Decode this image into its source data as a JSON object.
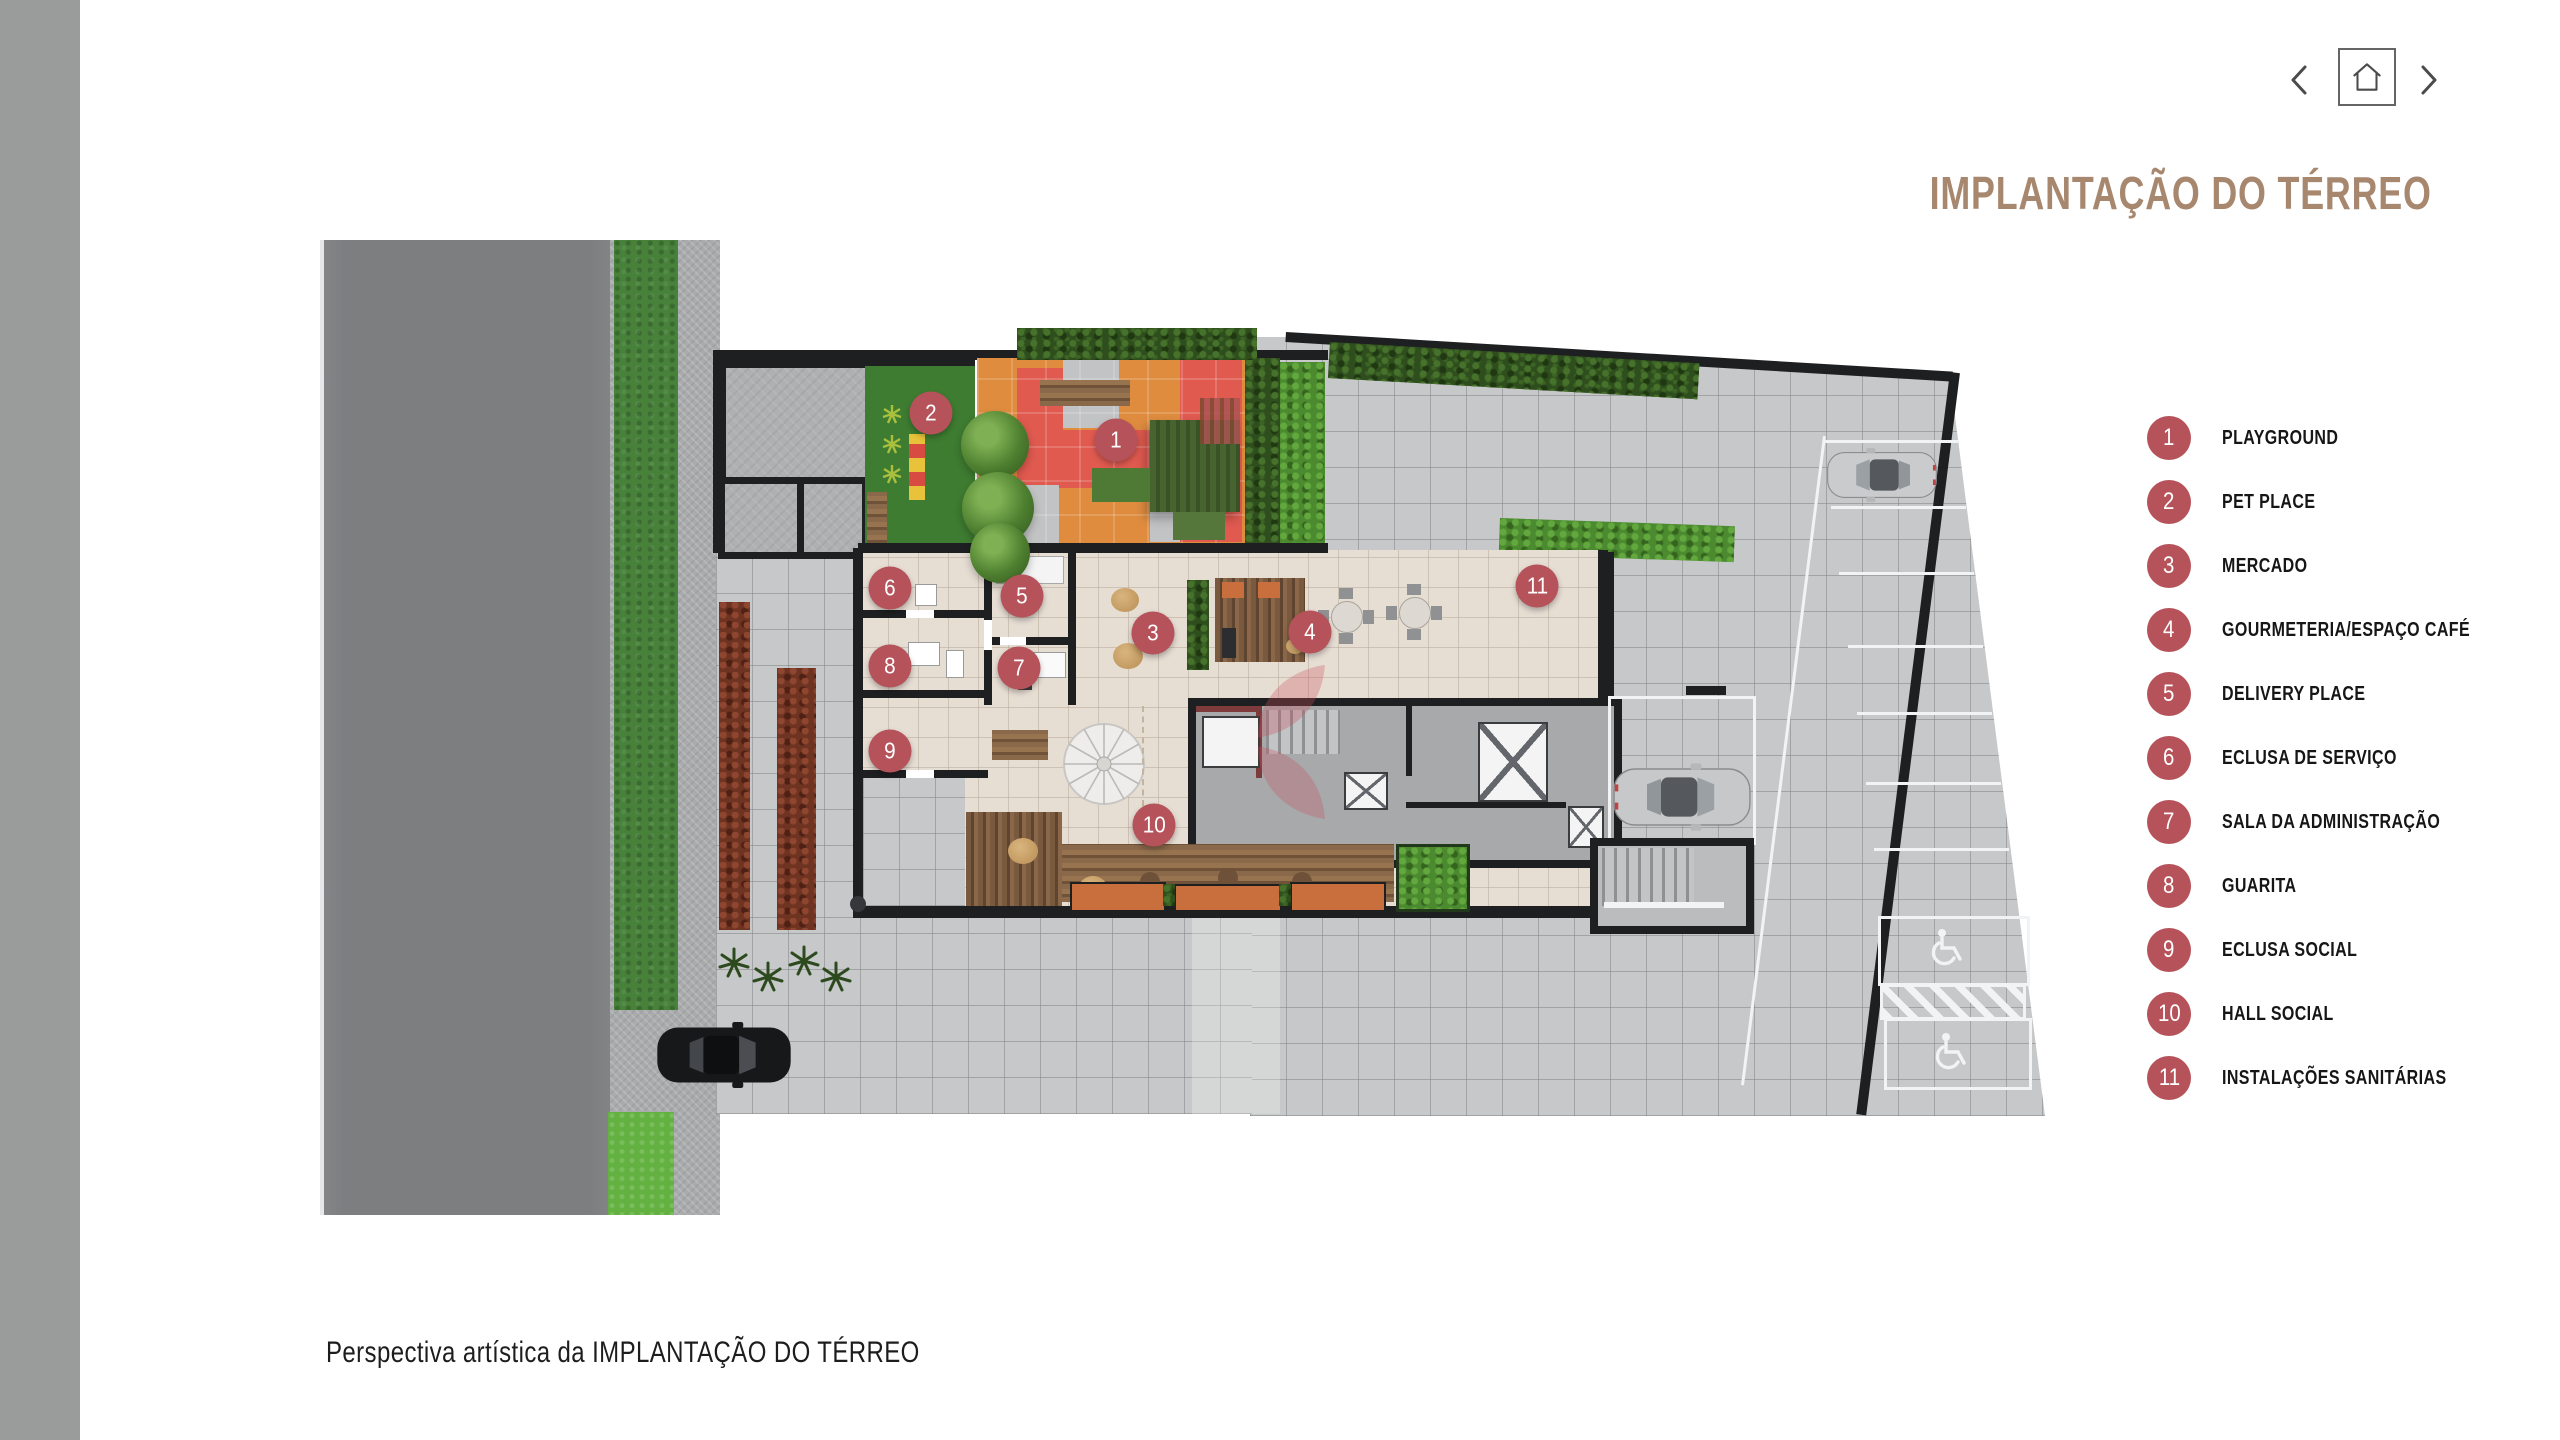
{
  "theme": {
    "marker_color": "#b5525a",
    "title_color": "#a8876f",
    "sidebar_color": "#9a9c9c",
    "road_color": "#7c7e80",
    "grass_color": "#47813a",
    "plaza_tile_color": "#c7c8c9",
    "interior_floor_color": "#e6ddd3",
    "wall_color": "#1e1f21"
  },
  "header": {
    "title": "IMPLANTAÇÃO DO TÉRREO",
    "nav": {
      "prev_icon": "chevron-left",
      "home_icon": "home",
      "next_icon": "chevron-right"
    }
  },
  "legend": {
    "items": [
      {
        "number": "1",
        "label": "PLAYGROUND"
      },
      {
        "number": "2",
        "label": "PET PLACE"
      },
      {
        "number": "3",
        "label": "MERCADO"
      },
      {
        "number": "4",
        "label": "GOURMETERIA/ESPAÇO CAFÉ"
      },
      {
        "number": "5",
        "label": "DELIVERY PLACE"
      },
      {
        "number": "6",
        "label": "ECLUSA DE SERVIÇO"
      },
      {
        "number": "7",
        "label": "SALA DA ADMINISTRAÇÃO"
      },
      {
        "number": "8",
        "label": "GUARITA"
      },
      {
        "number": "9",
        "label": "ECLUSA SOCIAL"
      },
      {
        "number": "10",
        "label": "HALL SOCIAL"
      },
      {
        "number": "11",
        "label": "INSTALAÇÕES SANITÁRIAS"
      }
    ]
  },
  "plan": {
    "markers": [
      {
        "number": "1",
        "x": 1116,
        "y": 440
      },
      {
        "number": "2",
        "x": 931,
        "y": 413
      },
      {
        "number": "3",
        "x": 1153,
        "y": 633
      },
      {
        "number": "4",
        "x": 1310,
        "y": 632
      },
      {
        "number": "5",
        "x": 1022,
        "y": 596
      },
      {
        "number": "6",
        "x": 890,
        "y": 588
      },
      {
        "number": "7",
        "x": 1019,
        "y": 668
      },
      {
        "number": "8",
        "x": 890,
        "y": 666
      },
      {
        "number": "9",
        "x": 890,
        "y": 751
      },
      {
        "number": "10",
        "x": 1154,
        "y": 825
      },
      {
        "number": "11",
        "x": 1537,
        "y": 586
      }
    ]
  },
  "caption": {
    "text": "Perspectiva artística da IMPLANTAÇÃO DO TÉRREO"
  }
}
